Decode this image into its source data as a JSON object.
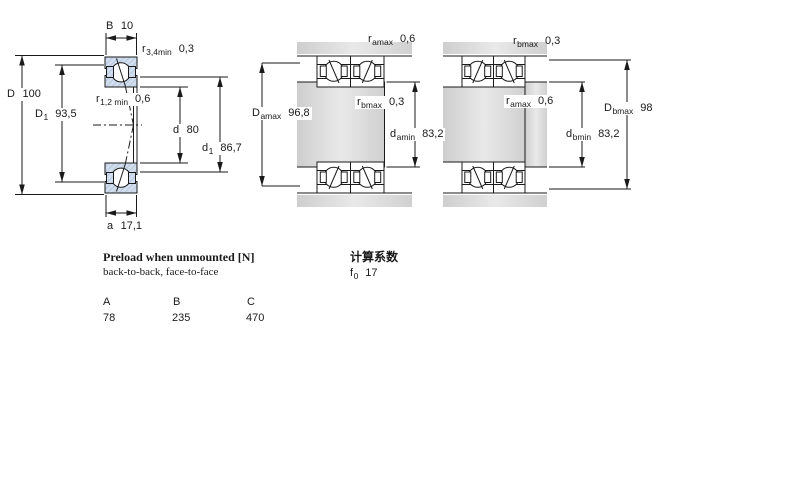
{
  "figures": {
    "single": {
      "dims": {
        "B": {
          "sym": "B",
          "sub": "",
          "val": "10"
        },
        "r34min": {
          "sym": "r",
          "sub": "3,4min",
          "val": "0,3"
        },
        "D": {
          "sym": "D",
          "sub": "",
          "val": "100"
        },
        "D1": {
          "sym": "D",
          "sub": "1",
          "val": "93,5"
        },
        "r12min": {
          "sym": "r",
          "sub": "1,2 min",
          "val": "0,6"
        },
        "d": {
          "sym": "d",
          "sub": "",
          "val": "80"
        },
        "d1": {
          "sym": "d",
          "sub": "1",
          "val": "86,7"
        },
        "a": {
          "sym": "a",
          "sub": "",
          "val": "17,1"
        }
      }
    },
    "pair_a": {
      "dims": {
        "ramax": {
          "sym": "r",
          "sub": "amax",
          "val": "0,6"
        },
        "rbmax": {
          "sym": "r",
          "sub": "bmax",
          "val": "0,3"
        },
        "Damax": {
          "sym": "D",
          "sub": "amax",
          "val": "96,8"
        },
        "damin": {
          "sym": "d",
          "sub": "amin",
          "val": "83,2"
        }
      }
    },
    "pair_b": {
      "dims": {
        "rbmax": {
          "sym": "r",
          "sub": "bmax",
          "val": "0,3"
        },
        "ramax": {
          "sym": "r",
          "sub": "amax",
          "val": "0,6"
        },
        "Dbmax": {
          "sym": "D",
          "sub": "bmax",
          "val": "98"
        },
        "dbmin": {
          "sym": "d",
          "sub": "bmin",
          "val": "83,2"
        }
      }
    }
  },
  "preload": {
    "title": "Preload when unmounted [N]",
    "subtitle": "back-to-back, face-to-face",
    "columns": [
      "A",
      "B",
      "C"
    ],
    "values": [
      "78",
      "235",
      "470"
    ]
  },
  "factors": {
    "title": "计算系数",
    "f0": {
      "sym": "f",
      "sub": "0",
      "val": "17"
    }
  }
}
